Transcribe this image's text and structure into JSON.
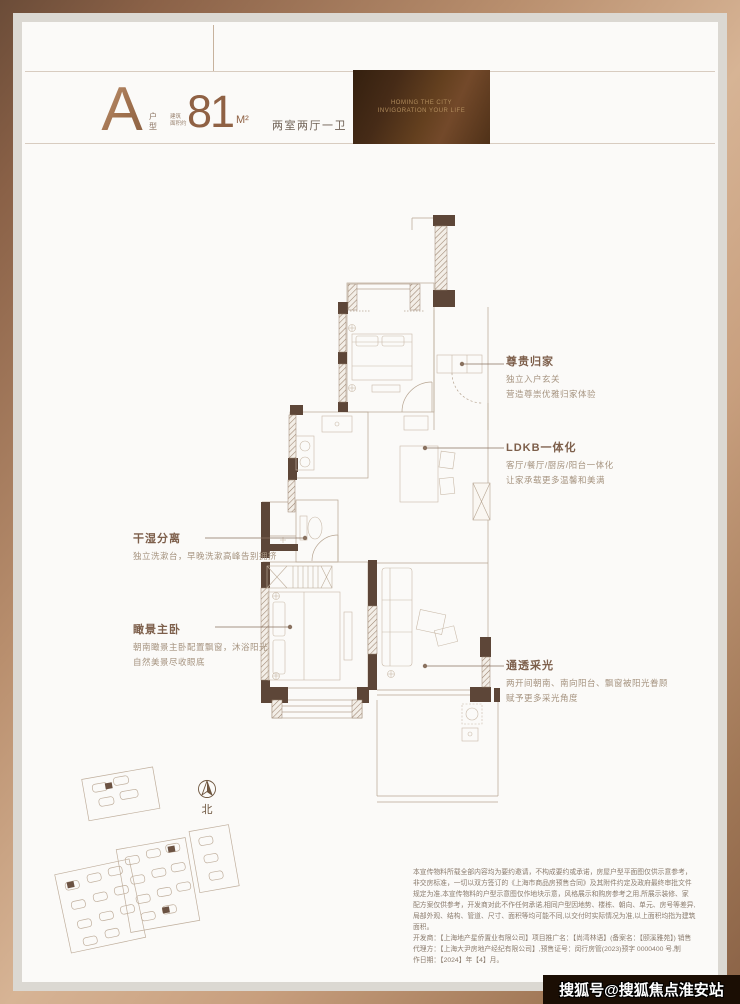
{
  "header": {
    "type_letter": "A",
    "type_label": "户型",
    "area_prefix_line1": "建筑",
    "area_prefix_line2": "面积约",
    "area_value": "81",
    "area_unit": "M²",
    "layout_text": "两室两厅一卫",
    "banner_line1": "HOMING THE CITY",
    "banner_line2": "INVIGORATION YOUR LIFE"
  },
  "annotations": {
    "right": [
      {
        "title": "尊贵归家",
        "lines": [
          "独立入户玄关",
          "营造尊崇优雅归家体验"
        ]
      },
      {
        "title": "LDKB一体化",
        "lines": [
          "客厅/餐厅/厨房/阳台一体化",
          "让家承载更多温馨和美满"
        ]
      },
      {
        "title": "通透采光",
        "lines": [
          "两开间朝南、南向阳台、飘窗被阳光眷顾",
          "赋予更多采光角度"
        ]
      }
    ],
    "left": [
      {
        "title": "干湿分离",
        "lines": [
          "独立洗漱台，早晚洗漱高峰告别拥挤"
        ]
      },
      {
        "title": "瞰景主卧",
        "lines": [
          "朝南瞰景主卧配置飘窗，沐浴阳光",
          "自然美景尽收眼底"
        ]
      }
    ]
  },
  "compass": {
    "label": "北"
  },
  "disclaimer": {
    "lines": [
      "本宣传物料所载全部内容均为要约邀请，不构成要约或承诺，房屋户型平面图仅供示意参考，",
      "非交房标准，一切以双方签订的《上海市商品房预售合同》及其附件约定及政府最终审批文件",
      "规定为准,本宣传物料的户型示意图仅作地块示意，风格展示和购房参考之用,所展示装修、家",
      "配方案仅供参考，开发商对此不作任何承诺,相同户型因地势、楼栋、朝向、单元、房号等差异,",
      "局部外观、结构、管道、尺寸、面积等均可能不同,以交付时实际情况为准,以上面积均指为建筑",
      "面积。",
      "开发商：【上海地产星侨置业有限公司】项目推广名：【尚湾林语】(备案名：【颐溪雅苑】) 销售",
      "代理方：【上海大尹房地产经纪有限公司】,预售证号：闵行房管(2023)预字 0000400 号,制",
      "作日期：【2024】年【4】月。"
    ]
  },
  "watermark": "搜狐号@搜狐焦点淮安站",
  "colors": {
    "accent_bronze": "#a97e5e",
    "wall_dark": "#5d4638",
    "line_light": "#b7a592",
    "banner_bg": "#462b17"
  }
}
